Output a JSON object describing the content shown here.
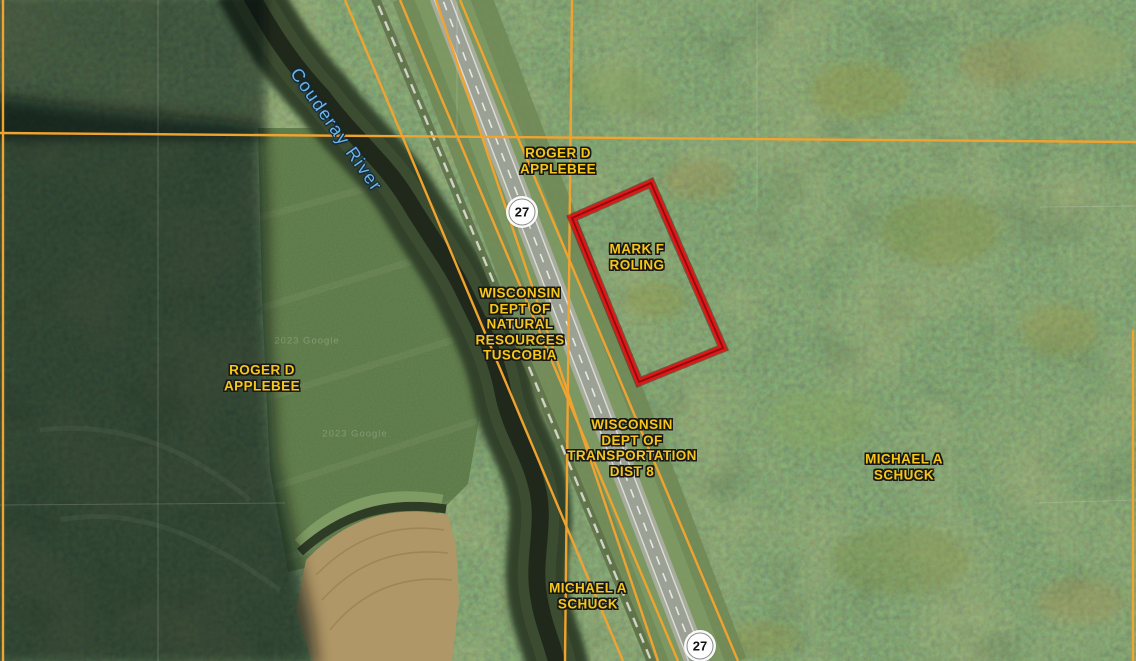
{
  "map": {
    "attribution": "2023 Google",
    "colors": {
      "parcel_line": "#f1a32f",
      "selected_parcel_outline": "#e31616",
      "owner_label_text": "#f6c71a",
      "water_label_text": "#6fb4e4",
      "section_line": "#ffffff"
    },
    "selected_parcel": {
      "owner": "MARK F ROLING"
    },
    "highway_markers": [
      {
        "route": "27"
      },
      {
        "route": "27"
      }
    ],
    "water_features": [
      {
        "name": "Couderay River"
      }
    ],
    "parcel_labels": {
      "applebee_north": {
        "owner": "ROGER D APPLEBEE",
        "lines": [
          "ROGER D",
          "APPLEBEE"
        ]
      },
      "roling": {
        "owner": "MARK F ROLING",
        "lines": [
          "MARK F",
          "ROLING"
        ]
      },
      "dnr": {
        "owner": "WISCONSIN DEPT OF NATURAL RESOURCES TUSCOBIA",
        "lines": [
          "WISCONSIN",
          "DEPT OF",
          "NATURAL",
          "RESOURCES",
          "TUSCOBIA"
        ]
      },
      "applebee_west": {
        "owner": "ROGER D APPLEBEE",
        "lines": [
          "ROGER D",
          "APPLEBEE"
        ]
      },
      "dot": {
        "owner": "WISCONSIN DEPT OF TRANSPORTATION DIST 8",
        "lines": [
          "WISCONSIN",
          "DEPT OF",
          "TRANSPORTATION",
          "DIST 8"
        ]
      },
      "schuck_east": {
        "owner": "MICHAEL A SCHUCK",
        "lines": [
          "MICHAEL A",
          "SCHUCK"
        ]
      },
      "schuck_south": {
        "owner": "MICHAEL A SCHUCK",
        "lines": [
          "MICHAEL A",
          "SCHUCK"
        ]
      }
    }
  }
}
